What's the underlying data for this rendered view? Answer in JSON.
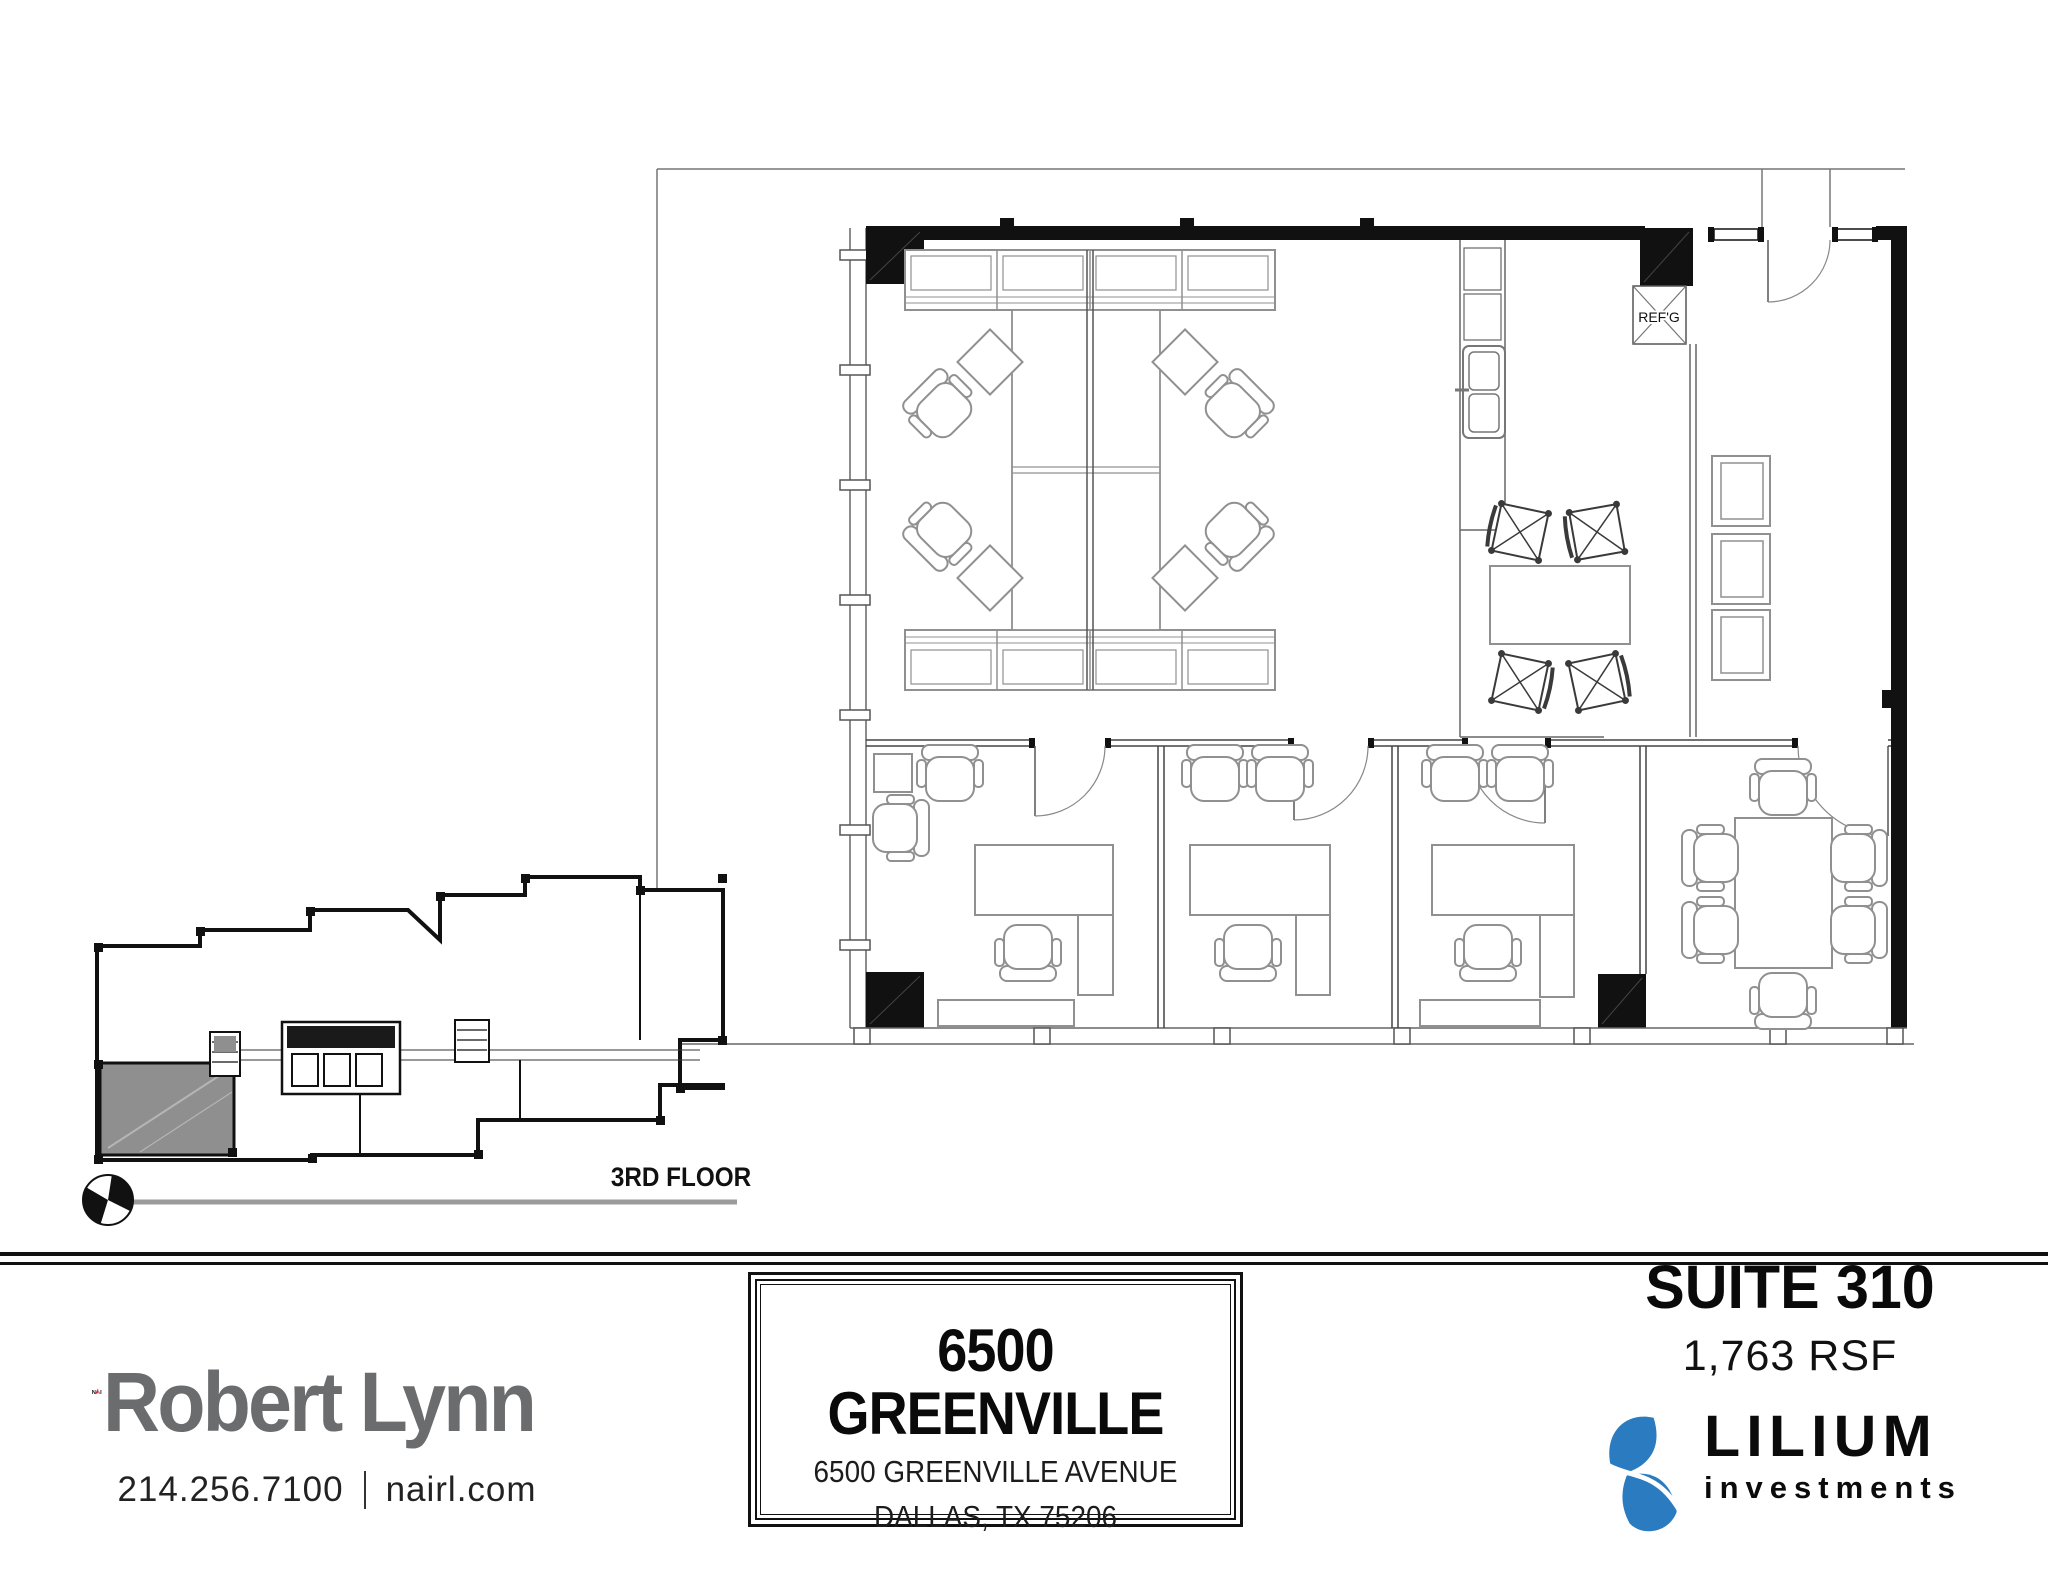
{
  "floor_plan": {
    "refrigerator_label": "REF'G",
    "wall_color": "#111111",
    "furniture_line_color": "#909090",
    "thin_line_color": "#555555"
  },
  "key_plan": {
    "floor_label": "3RD FLOOR",
    "suite_highlight_color": "#8f8f8f"
  },
  "footer": {
    "brokerage": {
      "logo_nai": "NAI",
      "logo_n": "N",
      "logo_i": "I",
      "logo_name": "Robert Lynn",
      "accent_red": "#c8313e",
      "name_gray": "#6a6c6e",
      "phone": "214.256.7100",
      "separator": "|",
      "website": "nairl.com"
    },
    "property": {
      "title": "6500 GREENVILLE",
      "address_line1": "6500 GREENVILLE AVENUE",
      "address_line2": "DALLAS, TX 75206"
    },
    "suite": {
      "name": "SUITE 310",
      "area": "1,763 RSF"
    },
    "investor": {
      "brand": "LILIUM",
      "brand_sub": "investments",
      "brand_blue": "#2b7bc0"
    }
  }
}
